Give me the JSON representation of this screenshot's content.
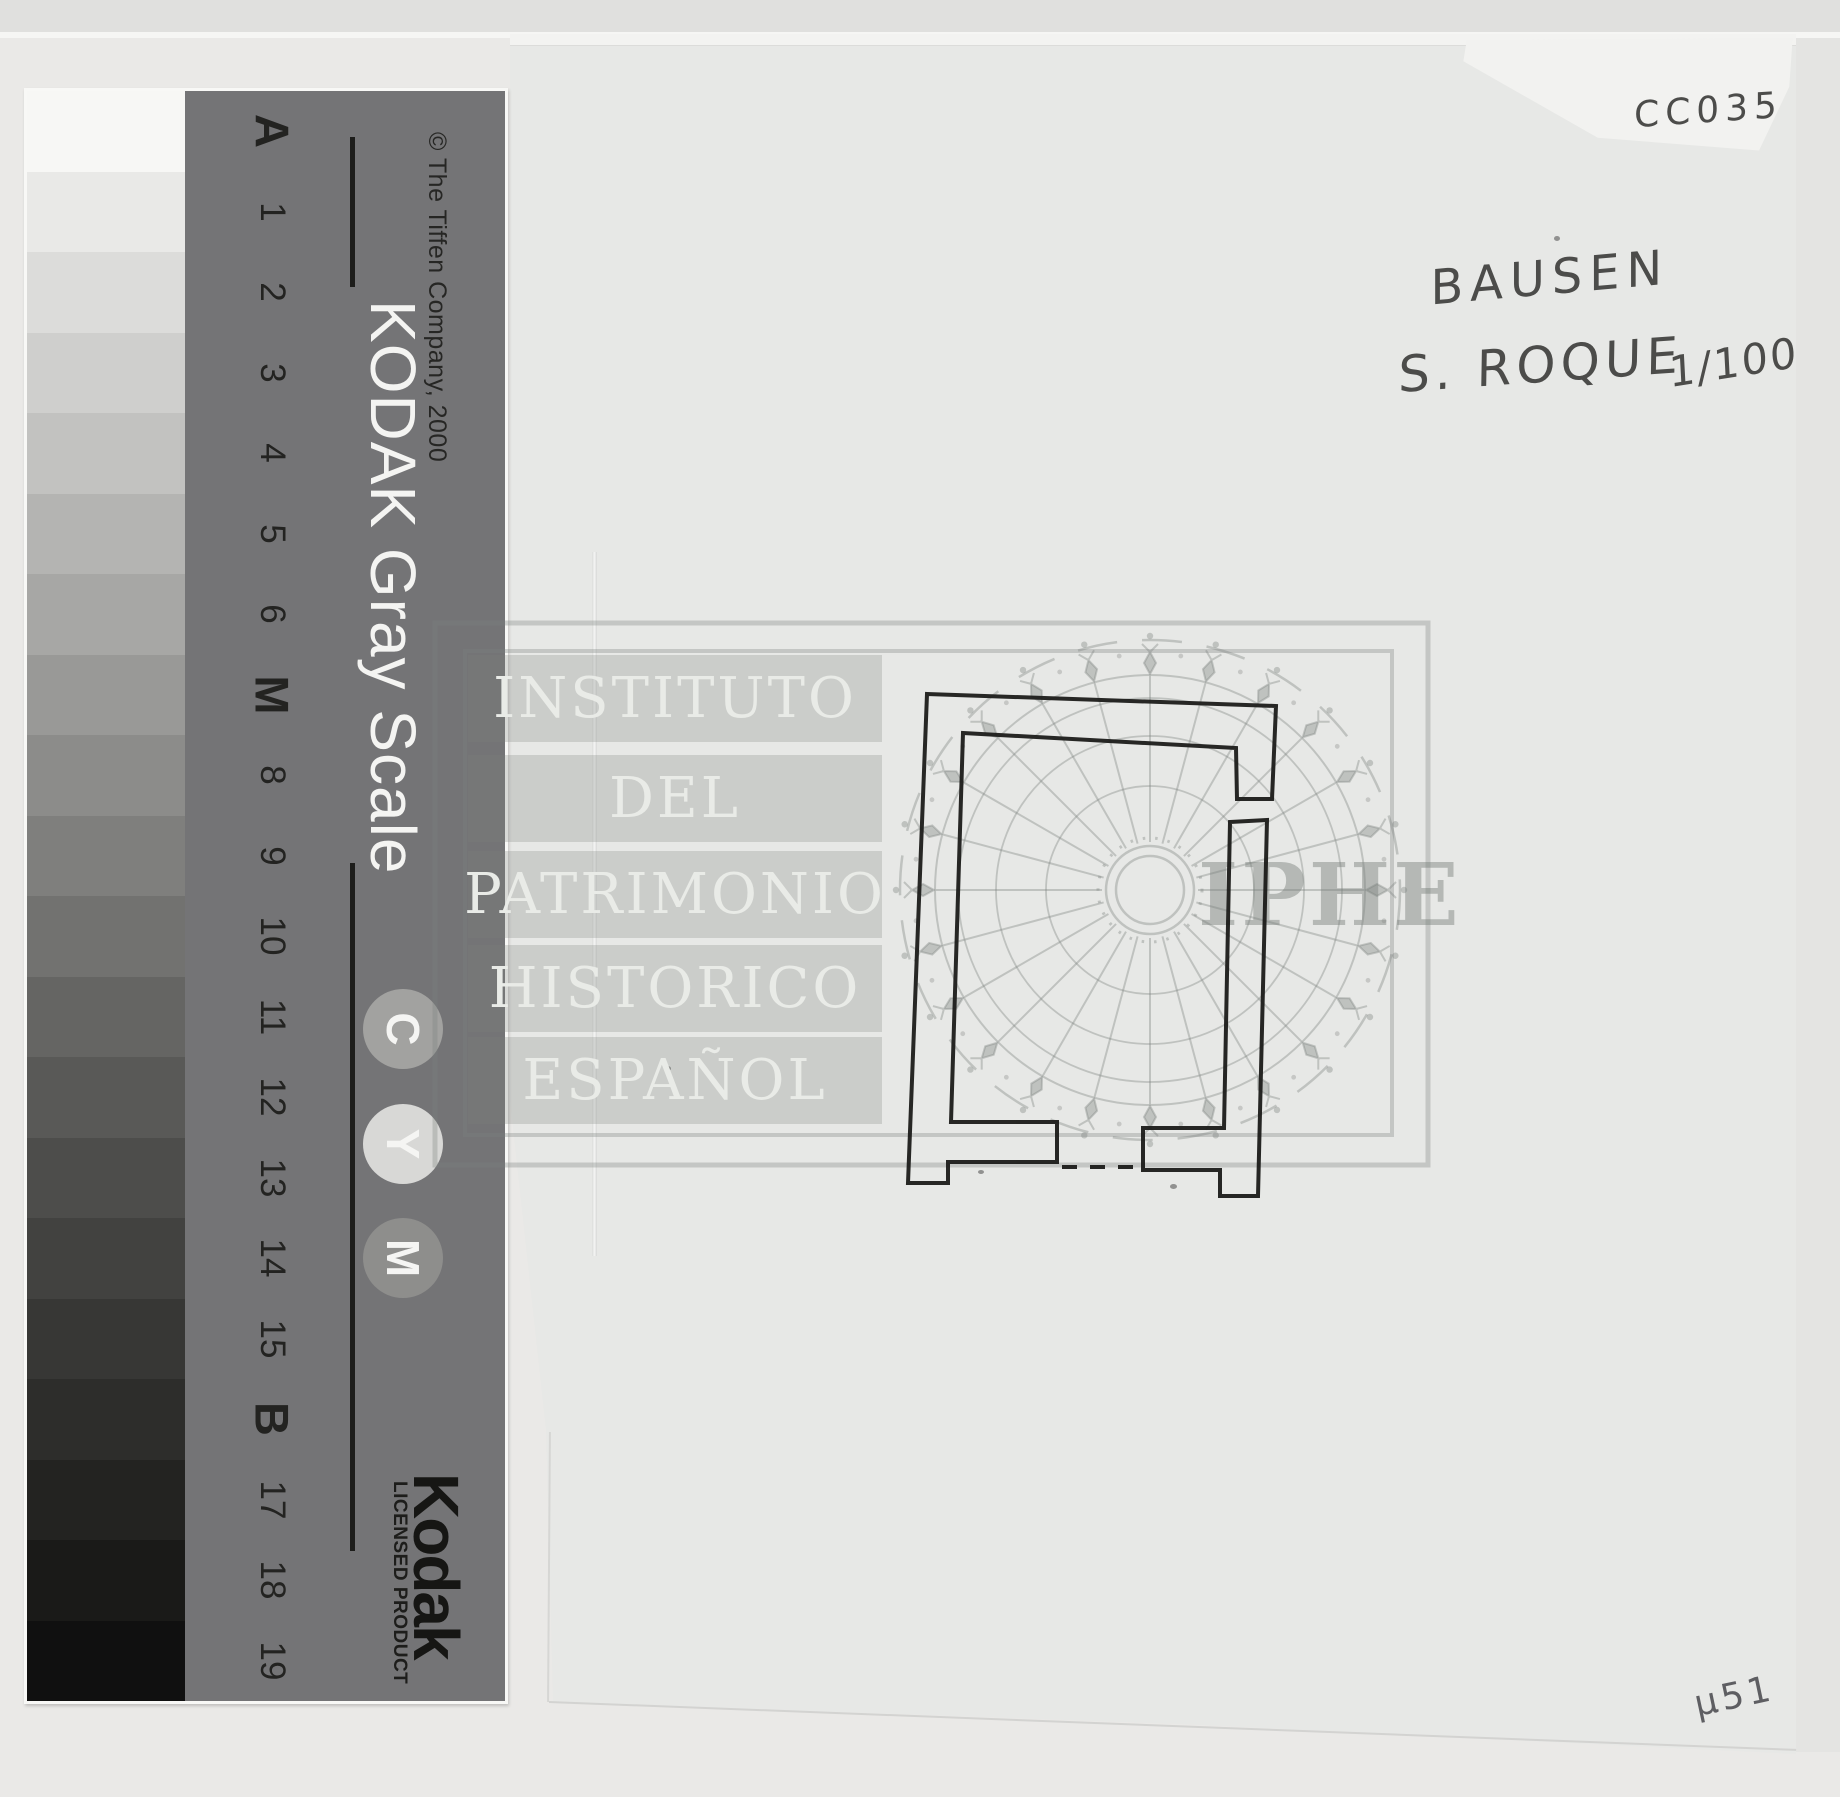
{
  "scan": {
    "archive_code": "CC035",
    "title_line1": "BAUSEN",
    "title_line2": "S. ROQUE",
    "scale_note": "1/100",
    "corner_number": "µ51",
    "ink_color": "#1c1c1a",
    "pencil_color": "#5e5e62"
  },
  "gray_scale": {
    "title": "KODAK Gray Scale",
    "copyright": "© The Tiffen Company, 2000",
    "brand": "Kodak",
    "brand_subtitle": "LICENSED PRODUCT",
    "panel_color": "#747476",
    "separator_letters": [
      "C",
      "Y",
      "M"
    ],
    "separator_colors": [
      "#a2a2a0",
      "#d8d8d6",
      "#8e8e8c"
    ],
    "patches": [
      {
        "label": "A",
        "color": "#f7f7f5",
        "bold": true
      },
      {
        "label": "1",
        "color": "#e9e9e7"
      },
      {
        "label": "2",
        "color": "#dcdcda"
      },
      {
        "label": "3",
        "color": "#cfcfcd"
      },
      {
        "label": "4",
        "color": "#c2c2c0"
      },
      {
        "label": "5",
        "color": "#b4b4b2"
      },
      {
        "label": "6",
        "color": "#a7a7a5"
      },
      {
        "label": "M",
        "color": "#999997",
        "bold": true
      },
      {
        "label": "8",
        "color": "#8c8c8a"
      },
      {
        "label": "9",
        "color": "#7f7f7d"
      },
      {
        "label": "10",
        "color": "#727270"
      },
      {
        "label": "11",
        "color": "#656563"
      },
      {
        "label": "12",
        "color": "#595957"
      },
      {
        "label": "13",
        "color": "#4d4d4b"
      },
      {
        "label": "14",
        "color": "#424240"
      },
      {
        "label": "15",
        "color": "#373735"
      },
      {
        "label": "B",
        "color": "#2d2d2b",
        "bold": true
      },
      {
        "label": "17",
        "color": "#232321"
      },
      {
        "label": "18",
        "color": "#1a1a18"
      },
      {
        "label": "19",
        "color": "#101010"
      }
    ]
  },
  "watermark": {
    "institution_lines": [
      "INSTITUTO",
      "DEL",
      "PATRIMONIO",
      "HISTORICO",
      "ESPAÑOL"
    ],
    "acronym": "IPHE",
    "gray": "#7b807d"
  }
}
